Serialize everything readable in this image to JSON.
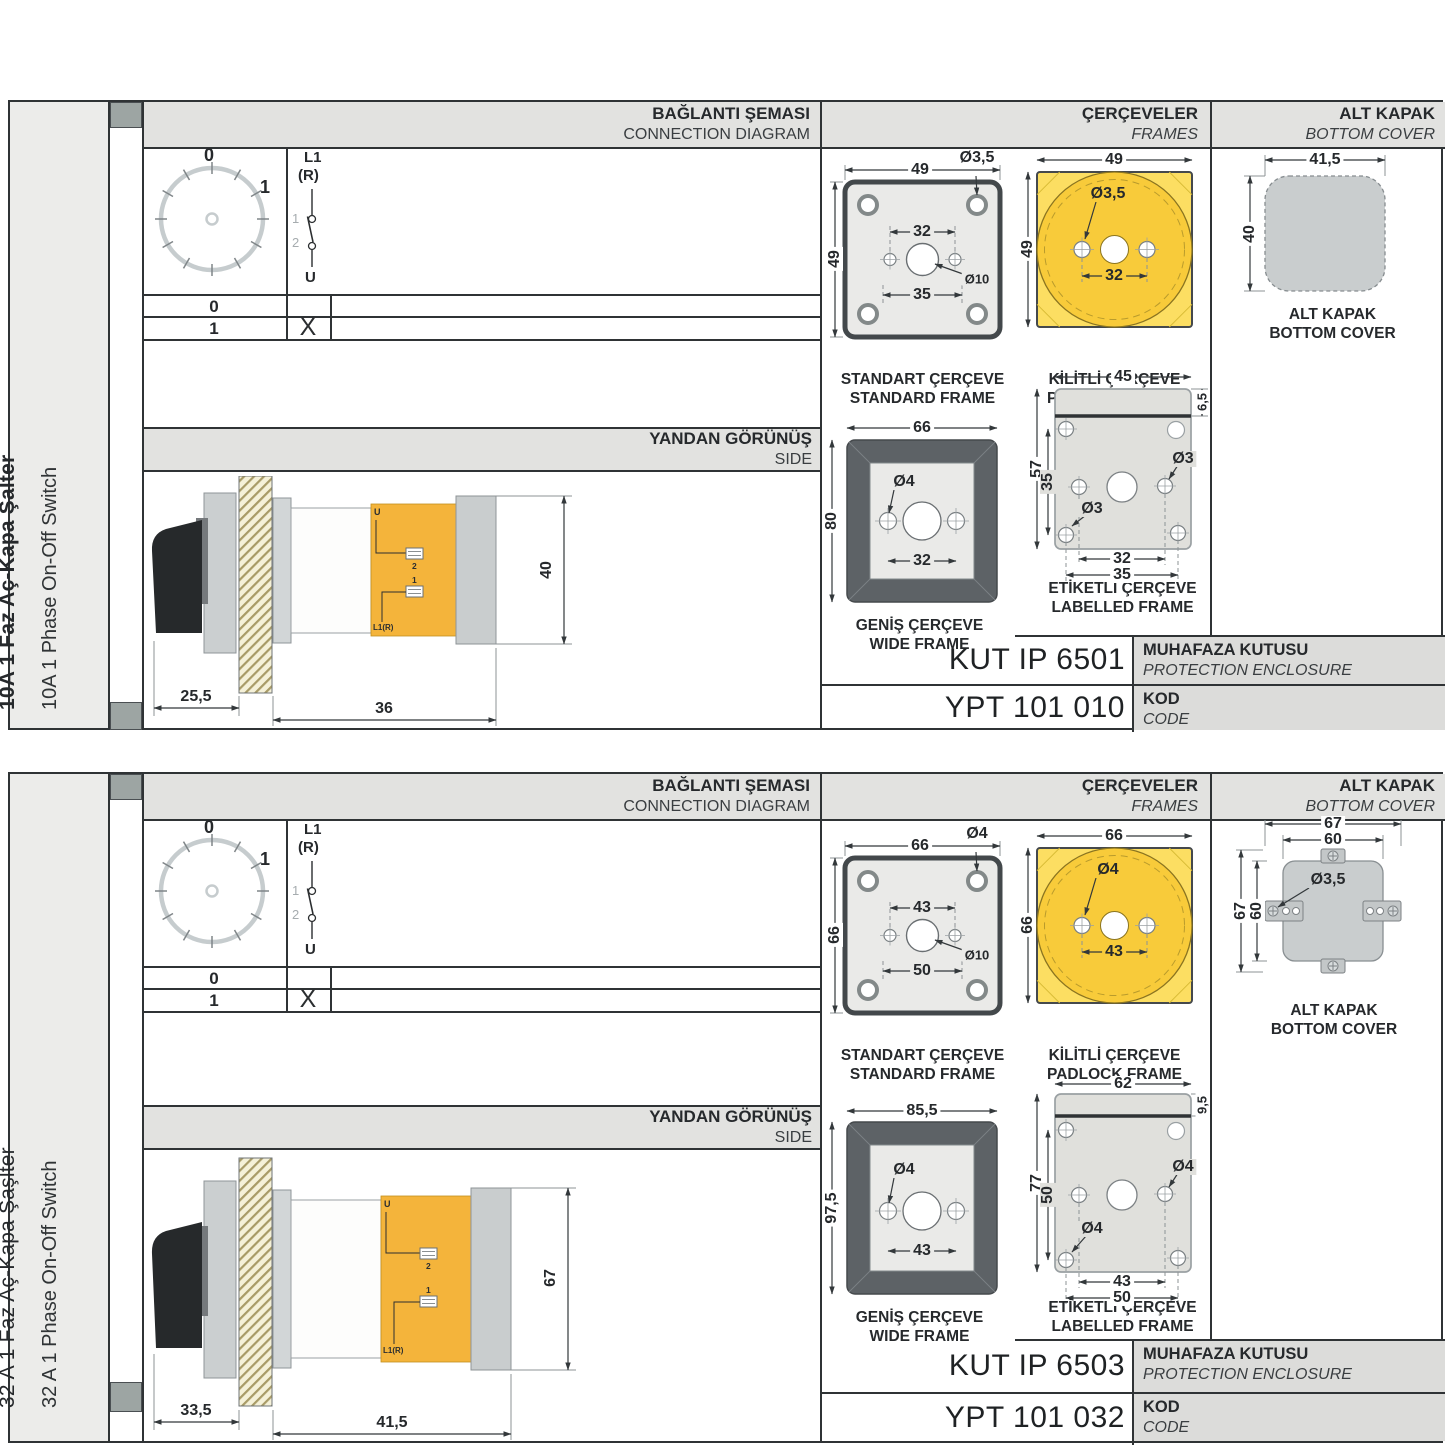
{
  "colors": {
    "accent_yellow": "#F8CB3A",
    "body_orange": "#F4B43B",
    "wide_frame_gray": "#5D6266",
    "cover_gray": "#C9CDCE"
  },
  "cards": [
    {
      "sidebar": {
        "title_tr": "10A 1 Faz Aç-Kapa Şalter",
        "title_en": "10A 1 Phase On-Off Switch"
      },
      "headers": {
        "connection_tr": "BAĞLANTI ŞEMASI",
        "connection_en": "CONNECTION DIAGRAM",
        "frames_tr": "ÇERÇEVELER",
        "frames_en": "FRAMES",
        "cover_tr": "ALT KAPAK",
        "cover_en": "BOTTOM COVER",
        "side_tr": "YANDAN GÖRÜNÜŞ",
        "side_en": "SIDE"
      },
      "diagram": {
        "dial_zero": "0",
        "dial_one": "1",
        "line_l1": "L1",
        "line_r": "(R)",
        "contact_1": "1",
        "contact_2": "2",
        "line_u": "U",
        "row_0": "0",
        "row_1": "1",
        "x_mark": "X"
      },
      "side_view": {
        "dim_front": "25,5",
        "dim_body": "36",
        "dim_height": "40",
        "lbl_u": "U",
        "lbl_2": "2",
        "lbl_1": "1",
        "lbl_l1r": "L1(R)"
      },
      "frames": {
        "standard": {
          "name_tr": "STANDART ÇERÇEVE",
          "name_en": "STANDARD FRAME",
          "dim_w": "49",
          "dim_h": "49",
          "hole": "Ø3,5",
          "dim_inner": "32",
          "center_hole": "Ø10",
          "dim_outer": "35"
        },
        "padlock": {
          "name_tr": "KİLİTLİ ÇERÇEVE",
          "name_en": "PADLOCK FRAME",
          "dim_w": "49",
          "dim_h": "49",
          "hole": "Ø3,5",
          "dim_inner": "32"
        },
        "wide": {
          "name_t r": "",
          "name_tr": "GENİŞ ÇERÇEVE",
          "name_en": "WIDE FRAME",
          "dim_w": "66",
          "dim_h": "80",
          "hole": "Ø4",
          "dim_inner": "32"
        },
        "labelled": {
          "name_tr": "ETİKETLİ ÇERÇEVE",
          "name_en": "LABELLED FRAME",
          "dim_w": "45",
          "dim_strip": "6,5",
          "dim_h": "57",
          "dim_rows": "35",
          "hole_top": "Ø3",
          "hole_bottom": "Ø3",
          "dim_inner": "32",
          "dim_outer": "35"
        }
      },
      "cover": {
        "label_tr": "ALT KAPAK",
        "label_en": "BOTTOM COVER",
        "dim_w": "41,5",
        "dim_h": "40"
      },
      "codes": {
        "enclosure_value": "KUT IP 6501",
        "enclosure_tr": "MUHAFAZA KUTUSU",
        "enclosure_en": "PROTECTION ENCLOSURE",
        "code_value": "YPT 101 010",
        "code_tr": "KOD",
        "code_en": "CODE"
      }
    },
    {
      "sidebar": {
        "title_tr": "32 A 1 Faz Aç-Kapa Şaşlter",
        "title_en": "32 A 1 Phase On-Off Switch"
      },
      "headers": {
        "connection_tr": "BAĞLANTI ŞEMASI",
        "connection_en": "CONNECTION DIAGRAM",
        "frames_tr": "ÇERÇEVELER",
        "frames_en": "FRAMES",
        "cover_tr": "ALT KAPAK",
        "cover_en": "BOTTOM COVER",
        "side_tr": "YANDAN GÖRÜNÜŞ",
        "side_en": "SIDE"
      },
      "diagram": {
        "dial_zero": "0",
        "dial_one": "1",
        "line_l1": "L1",
        "line_r": "(R)",
        "contact_1": "1",
        "contact_2": "2",
        "line_u": "U",
        "row_0": "0",
        "row_1": "1",
        "x_mark": "X"
      },
      "side_view": {
        "dim_front": "33,5",
        "dim_body": "41,5",
        "dim_height": "67",
        "lbl_u": "U",
        "lbl_2": "2",
        "lbl_1": "1",
        "lbl_l1r": "L1(R)"
      },
      "frames": {
        "standard": {
          "name_tr": "STANDART ÇERÇEVE",
          "name_en": "STANDARD FRAME",
          "dim_w": "66",
          "dim_h": "66",
          "hole": "Ø4",
          "dim_inner": "43",
          "center_hole": "Ø10",
          "dim_outer": "50"
        },
        "padlock": {
          "name_tr": "KİLİTLİ ÇERÇEVE",
          "name_en": "PADLOCK FRAME",
          "dim_w": "66",
          "dim_h": "66",
          "hole": "Ø4",
          "dim_inner": "43"
        },
        "wide": {
          "name_tr": "GENİŞ ÇERÇEVE",
          "name_en": "WIDE FRAME",
          "dim_w": "85,5",
          "dim_h": "97,5",
          "hole": "Ø4",
          "dim_inner": "43"
        },
        "labelled": {
          "name_tr": "ETİKETLİ ÇERÇEVE",
          "name_en": "LABELLED FRAME",
          "dim_w": "62",
          "dim_strip": "9,5",
          "dim_h": "77",
          "dim_rows": "50",
          "hole_top": "Ø4",
          "hole_bottom": "Ø4",
          "dim_inner": "43",
          "dim_outer": "50"
        }
      },
      "cover": {
        "label_tr": "ALT KAPAK",
        "label_en": "BOTTOM COVER",
        "dim_w_outer": "67",
        "dim_w_inner": "60",
        "dim_h_outer": "67",
        "dim_h_inner": "60",
        "hole": "Ø3,5"
      },
      "codes": {
        "enclosure_value": "KUT IP 6503",
        "enclosure_tr": "MUHAFAZA KUTUSU",
        "enclosure_en": "PROTECTION ENCLOSURE",
        "code_value": "YPT 101 032",
        "code_tr": "KOD",
        "code_en": "CODE"
      }
    }
  ]
}
